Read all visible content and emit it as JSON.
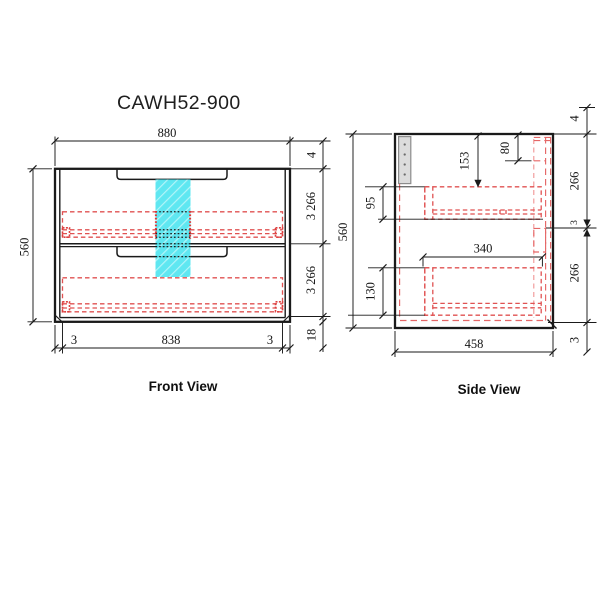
{
  "title": "CAWH52-900",
  "front_view": {
    "label": "Front View",
    "dim_width": "880",
    "dim_height": "560",
    "dim_top_gap": "4",
    "dim_drawer1_front": "3  266",
    "dim_drawer2_front": "3  266",
    "dim_kick": "18",
    "dim_bottom_gap_left": "3",
    "dim_bottom_inner_width": "838",
    "dim_bottom_gap_right": "3"
  },
  "side_view": {
    "label": "Side View",
    "dim_height": "560",
    "dim_top_gap": "4",
    "dim_front_upper": "266",
    "dim_mid_gap": "3",
    "dim_front_lower": "266",
    "dim_bottom_gap": "3",
    "dim_handle_recess": "80",
    "dim_top_to_box": "153",
    "dim_upper_box_height": "95",
    "dim_lower_box_height": "130",
    "dim_drawer_depth": "340",
    "dim_cabinet_depth": "458"
  },
  "colors": {
    "highlight_cyan": "#49e4ef",
    "drawer_red": "#e05252",
    "line_black": "#1a1a1a",
    "bracket_grey": "#dcdcdc"
  }
}
